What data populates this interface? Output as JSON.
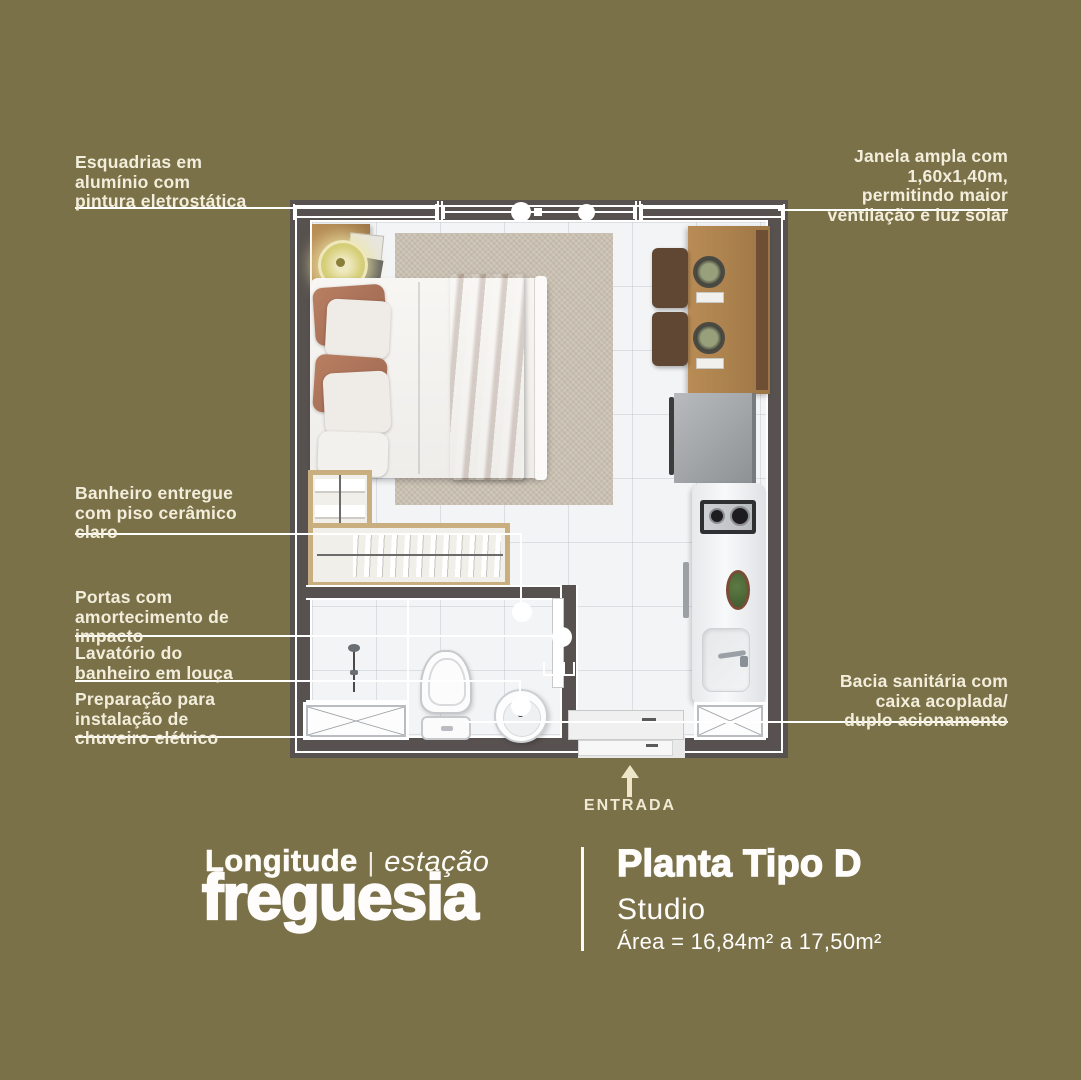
{
  "palette": {
    "background": "#7b7149",
    "wall": "#57514f",
    "floor": "#f3f4f6",
    "callout_line": "#ffffff",
    "label_text": "#f3eedb",
    "brand_text": "#fdfcf8",
    "wood": "#b08756",
    "rug": "#c9bfb1",
    "blanket": "#a7705a",
    "lamp": "#d6cf7a"
  },
  "callouts": {
    "esquadrias": "Esquadrias em\nalumínio com\npintura eletrostática",
    "janela": "Janela ampla com\n1,60x1,40m,\npermitindo maior\nventilação e luz solar",
    "banheiro": "Banheiro entregue\ncom piso cerâmico\nclaro",
    "portas": "Portas com\namortecimento de\nimpacto",
    "lavatorio": "Lavatório do\nbanheiro em louça",
    "preparacao": "Preparação para\ninstalação de\nchuveiro elétrico",
    "bacia": "Bacia sanitária com\ncaixa acoplada/\nduplo acionamento"
  },
  "entrance": {
    "label": "ENTRADA"
  },
  "brand": {
    "name": "Longitude",
    "separator": "|",
    "tagline": "estação",
    "project": "freguesia"
  },
  "plan_info": {
    "title": "Planta Tipo D",
    "subtitle": "Studio",
    "area": "Área = 16,84m² a 17,50m²"
  }
}
